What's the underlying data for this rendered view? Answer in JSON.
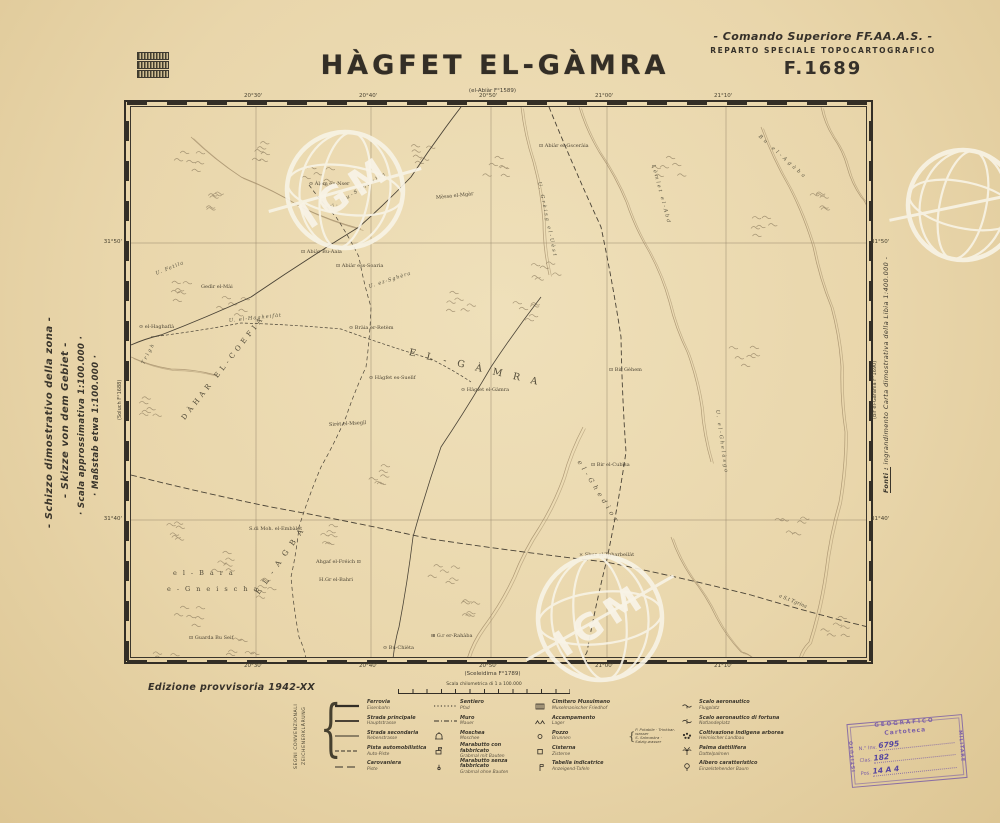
{
  "page": {
    "title": "HÀGFET EL-GÀMRA",
    "top_sheet_ref": "(el-Abiàr F°1589)",
    "header_right": {
      "line1": "- Comando Superiore FF.AA.A.S. -",
      "line2": "REPARTO SPECIALE TOPOCARTOGRAFICO",
      "line3": "F.1689"
    },
    "edition": "Edizione provvisoria 1942-XX"
  },
  "margin_left_lines": [
    "- Schizzo dimostrativo della zona -",
    "- Skizze von dem Gebiet -",
    "· Scala approssimativa 1:100.000 ·",
    "· Maßstab etwa 1:100.000 ·"
  ],
  "margin_right": {
    "label": "Fonti :",
    "text": " ingrandimento Carta dimostrativa della Libia  1:400.000 -"
  },
  "frame": {
    "top_ticks": [
      "20°30'",
      "20°40'",
      "20°50'",
      "21°00'",
      "21°10'"
    ],
    "bottom_ticks": [
      "20°30'",
      "20°40'",
      "20°50'",
      "21°00'",
      "21°10'"
    ],
    "left_ticks": [
      "31°50'",
      "31°40'"
    ],
    "right_ticks": [
      "31°50'",
      "31°40'"
    ],
    "left_sheet": "(Soluch F°1688)",
    "right_sheet": "(Bir el-Garanìa F°1690)",
    "bottom_sheet": "(Sceleidima F°1789)"
  },
  "map_labels": [
    {
      "t": "⊙ Àlem en-Nser",
      "x": 178,
      "y": 74,
      "r": 0,
      "c": "pl"
    },
    {
      "t": "U. Bu-Sandàlla",
      "x": 200,
      "y": 98,
      "r": -32,
      "c": "wd",
      "ls": 2
    },
    {
      "t": "Mèssa el-Mgàr",
      "x": 305,
      "y": 88,
      "r": -6,
      "c": "pl"
    },
    {
      "t": "⊡ Abiàr el-Gsceràia",
      "x": 408,
      "y": 36,
      "r": 0,
      "c": "pl"
    },
    {
      "t": "Bu el-Agàba",
      "x": 628,
      "y": 26,
      "r": 42,
      "c": "wd",
      "ls": 3
    },
    {
      "t": "U. Grèisg el-Uèst",
      "x": 408,
      "y": 72,
      "r": 78,
      "c": "wd",
      "ls": 2
    },
    {
      "t": "Lèmlet el-Abd",
      "x": 522,
      "y": 55,
      "r": 75,
      "c": "wd",
      "ls": 2
    },
    {
      "t": "U. Fetìla",
      "x": 25,
      "y": 164,
      "r": -22,
      "c": "wd",
      "ls": 1
    },
    {
      "t": "Gedìr el-Mài",
      "x": 70,
      "y": 177,
      "r": 0,
      "c": "pl"
    },
    {
      "t": "⊡ Abiàr Bu-Aala",
      "x": 170,
      "y": 142,
      "r": 0,
      "c": "pl"
    },
    {
      "t": "⊡ Abiàr ess-Soarìa",
      "x": 205,
      "y": 156,
      "r": 0,
      "c": "pl"
    },
    {
      "t": "U. ez-Sghèra",
      "x": 238,
      "y": 177,
      "r": -18,
      "c": "wd",
      "ls": 1
    },
    {
      "t": "⊙ Bràia er-Retèm",
      "x": 218,
      "y": 218,
      "r": 0,
      "c": "pl"
    },
    {
      "t": "⊙ el-Haghaflà",
      "x": 8,
      "y": 217,
      "r": 0,
      "c": "pl"
    },
    {
      "t": "U. el-Hagheifàt",
      "x": 98,
      "y": 211,
      "r": -6,
      "c": "wd",
      "ls": 1
    },
    {
      "t": "Trìgh",
      "x": 12,
      "y": 254,
      "r": -62,
      "c": "wd",
      "ls": 2
    },
    {
      "t": "DÀHAR EL-COEFIA",
      "x": 52,
      "y": 308,
      "r": -52,
      "c": "ar",
      "fs": 7,
      "ls": 4
    },
    {
      "t": "EL-GÀMRA",
      "x": 278,
      "y": 240,
      "r": 13,
      "c": "ar",
      "fs": 9.5,
      "ls": 11
    },
    {
      "t": "⊙ Hàgfet es-Suelìf",
      "x": 238,
      "y": 268,
      "r": 0,
      "c": "pl"
    },
    {
      "t": "⊙ Hàgfet el-Gàmra",
      "x": 330,
      "y": 280,
      "r": 0,
      "c": "pl"
    },
    {
      "t": "Sirèt el-Msegìl",
      "x": 198,
      "y": 315,
      "r": -3,
      "c": "pl"
    },
    {
      "t": "⊡ Bir Gèhem",
      "x": 478,
      "y": 260,
      "r": 0,
      "c": "pl"
    },
    {
      "t": "⊡ Bir el-Cubìsa",
      "x": 460,
      "y": 355,
      "r": 0,
      "c": "pl"
    },
    {
      "t": "U. el-Ghelàsgo",
      "x": 586,
      "y": 300,
      "r": 82,
      "c": "wd",
      "ls": 2
    },
    {
      "t": "el-Ghedìor",
      "x": 448,
      "y": 350,
      "r": 58,
      "c": "wd2",
      "ls": 4
    },
    {
      "t": "× Sbur el-Tgharbeilàt",
      "x": 448,
      "y": 445,
      "r": 0,
      "c": "pl"
    },
    {
      "t": "a S.t Tgrìna",
      "x": 648,
      "y": 486,
      "r": 22,
      "c": "wd"
    },
    {
      "t": "S.di Moh. el-Embàlet",
      "x": 118,
      "y": 419,
      "r": 0,
      "c": "pl"
    },
    {
      "t": "Ahgaf el-Fréich ⊡",
      "x": 185,
      "y": 452,
      "r": 0,
      "c": "pl"
    },
    {
      "t": "H.Gr el-Bahri",
      "x": 188,
      "y": 470,
      "r": 0,
      "c": "pl"
    },
    {
      "t": "el-Bara",
      "x": 42,
      "y": 462,
      "r": 0,
      "c": "ar2",
      "ls": 6
    },
    {
      "t": "e-Gneischa",
      "x": 36,
      "y": 478,
      "r": 0,
      "c": "ar2",
      "ls": 6
    },
    {
      "t": "EL-AGBA",
      "x": 126,
      "y": 482,
      "r": -55,
      "c": "ar",
      "fs": 7.5,
      "ls": 7
    },
    {
      "t": "⊡ Guarda Bu Seif",
      "x": 58,
      "y": 528,
      "r": 0,
      "c": "pl"
    },
    {
      "t": "⊞ G.r er-Rahàba",
      "x": 300,
      "y": 526,
      "r": 0,
      "c": "pl"
    },
    {
      "t": "⊙ Bu-Chièta",
      "x": 252,
      "y": 538,
      "r": 0,
      "c": "pl"
    }
  ],
  "scalebar": {
    "label": "Scala chilometrica di 1 a 100.000"
  },
  "legend": {
    "header_line1": "SEGNI CONVENZIONALI",
    "header_line2": "ZEICHENERKLÄRUNG",
    "columns": [
      {
        "rows": [
          {
            "sym": "rail",
            "it": "Ferrovia",
            "de": "Eisenbahn"
          },
          {
            "sym": "road1",
            "it": "Strada principale",
            "de": "Hauptstrasse"
          },
          {
            "sym": "road2",
            "it": "Strada secondaria",
            "de": "Nebenstrasse"
          },
          {
            "sym": "track",
            "it": "Pista automobilistica",
            "de": "Auto-Piste"
          },
          {
            "sym": "caravan",
            "it": "Carovaniera",
            "de": "Piste"
          }
        ]
      },
      {
        "rows": [
          {
            "sym": "path",
            "it": "Sentiero",
            "de": "Pfad"
          },
          {
            "sym": "wall",
            "it": "Muro",
            "de": "Mauer"
          },
          {
            "sym": "mosque",
            "it": "Moschea",
            "de": "Moschee"
          },
          {
            "sym": "marab1",
            "it": "Marabutto con fabbricato",
            "de": "Grabmal mit Bauten"
          },
          {
            "sym": "marab2",
            "it": "Marabutto senza fabbricato",
            "de": "Grabmal ohne Bauten"
          }
        ]
      },
      {
        "rows": [
          {
            "sym": "cem",
            "it": "Cimitero Musulmano",
            "de": "Muselmanischer Friedhof"
          },
          {
            "sym": "camp",
            "it": "Accampamento",
            "de": "Lager"
          },
          {
            "sym": "well",
            "it": "Pozzo",
            "de": "Brunnen",
            "extra": [
              {
                "line": "P. Potabile · Trinkbar-wasser"
              },
              {
                "line": "S. Salmastra · Salzig-wasser"
              }
            ]
          },
          {
            "sym": "cistern",
            "it": "Cisterna",
            "de": "Zisterne"
          },
          {
            "sym": "sign",
            "it": "Tabella indicatrice",
            "de": "Anzeigend-Tafeln"
          }
        ]
      },
      {
        "rows": [
          {
            "sym": "airfield",
            "it": "Scalo aeronautico",
            "de": "Flugplatz"
          },
          {
            "sym": "airfield2",
            "it": "Scalo aeronautico di fortuna",
            "de": "Notlandeplatz"
          },
          {
            "sym": "cultiv",
            "it": "Coltivazione indigena arborea",
            "de": "Heimischer Landbau"
          },
          {
            "sym": "palm",
            "it": "Palma dattilifera",
            "de": "Dattelpalmen"
          },
          {
            "sym": "tree",
            "it": "Albero caratteristico",
            "de": "Einzelstehender Baum"
          }
        ]
      }
    ]
  },
  "stamp": {
    "border_top": "GEOGRAFICO",
    "border_left": "ISTITUTO",
    "border_right": "MILITARE",
    "inner_title": "Cartoteca",
    "lines": [
      {
        "label": "N.° Inv.",
        "value": "6795"
      },
      {
        "label": "Clas.",
        "value": "182"
      },
      {
        "label": "Pos.",
        "value": "14 A 4"
      }
    ]
  },
  "watermark_text": "IGM",
  "colors": {
    "paper": "#e9d6ab",
    "ink": "#332e26",
    "faded_line": "#8d7c5f",
    "wadi": "#a08a67",
    "stamp_purple": "#7b5fa6",
    "watermark_white": "#f8f3e6"
  }
}
